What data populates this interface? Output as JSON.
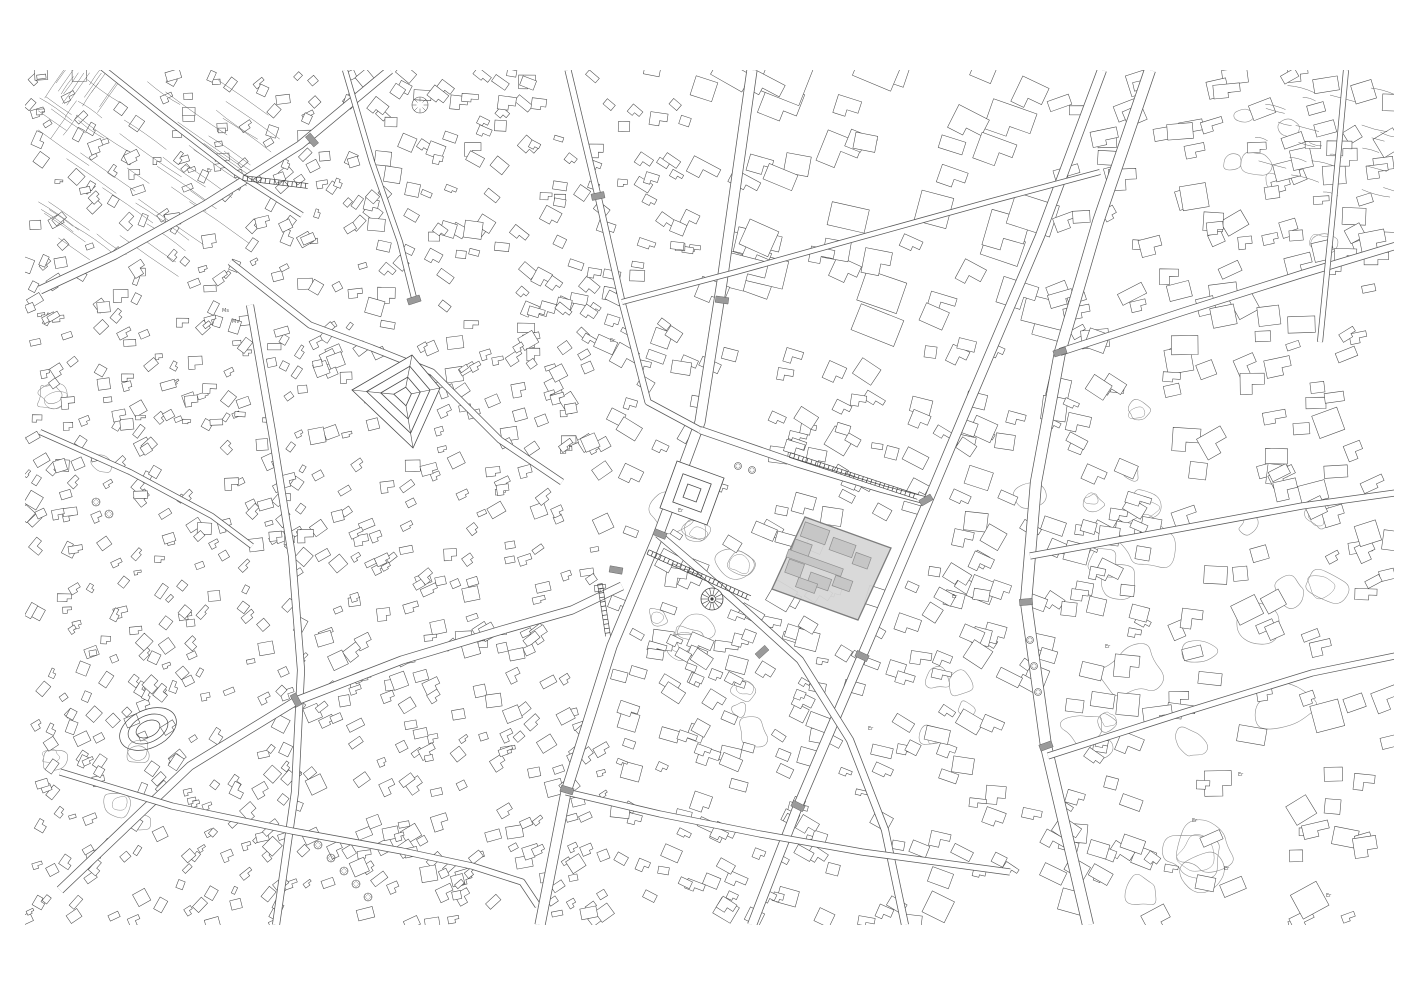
{
  "page": {
    "width": 1419,
    "height": 1000,
    "background": "#ffffff"
  },
  "map": {
    "x": 25,
    "y": 70,
    "w": 1369,
    "h": 855,
    "background": "#ffffff",
    "building_stroke": "#4a4a4a",
    "street_edge": "#5a5a5a",
    "park_stroke": "#8a8a8a",
    "crossing_fill": "#9a9a9a",
    "detail_stroke": "#3d3d3d",
    "seed": 20240521
  },
  "highlight": {
    "polygon": [
      [
        805,
        517
      ],
      [
        891,
        548
      ],
      [
        858,
        620
      ],
      [
        772,
        589
      ]
    ],
    "fill": "#d6d6d6",
    "stroke": "#7d7d7d",
    "angle_deg": 19.8,
    "building_fill": "#c6c6c6",
    "building_stroke": "#8e8e8e",
    "buildings_local": [
      {
        "a": 16,
        "b": 12,
        "w": 26,
        "h": 15
      },
      {
        "a": 47,
        "b": 16,
        "w": 24,
        "h": 13
      },
      {
        "a": 70,
        "b": 22,
        "w": 16,
        "h": 12
      },
      {
        "a": 10,
        "b": 32,
        "w": 18,
        "h": 16
      },
      {
        "a": 28,
        "b": 40,
        "w": 58,
        "h": 8
      },
      {
        "a": 12,
        "b": 52,
        "w": 16,
        "h": 14
      },
      {
        "a": 40,
        "b": 56,
        "w": 22,
        "h": 12
      },
      {
        "a": 62,
        "b": 50,
        "w": 18,
        "h": 11
      },
      {
        "a": 30,
        "b": 64,
        "w": 20,
        "h": 10
      }
    ]
  },
  "streets": [
    {
      "name": "nw-avenue",
      "w": 9,
      "pts": [
        [
          390,
          70
        ],
        [
          300,
          145
        ],
        [
          205,
          205
        ],
        [
          115,
          255
        ],
        [
          40,
          290
        ]
      ]
    },
    {
      "name": "nw-upper-lane",
      "w": 6,
      "pts": [
        [
          95,
          62
        ],
        [
          165,
          118
        ],
        [
          235,
          172
        ],
        [
          302,
          215
        ]
      ]
    },
    {
      "name": "old-town-lane",
      "w": 7,
      "pts": [
        [
          230,
          262
        ],
        [
          310,
          325
        ],
        [
          372,
          348
        ],
        [
          432,
          372
        ],
        [
          500,
          440
        ],
        [
          562,
          482
        ]
      ]
    },
    {
      "name": "left-vertical-street",
      "w": 8,
      "pts": [
        [
          250,
          305
        ],
        [
          272,
          432
        ],
        [
          292,
          556
        ],
        [
          301,
          670
        ],
        [
          295,
          792
        ],
        [
          276,
          925
        ]
      ]
    },
    {
      "name": "west-mid-lane",
      "w": 6,
      "pts": [
        [
          40,
          432
        ],
        [
          130,
          472
        ],
        [
          212,
          516
        ],
        [
          252,
          546
        ]
      ]
    },
    {
      "name": "sw-diagonal",
      "w": 9,
      "pts": [
        [
          60,
          890
        ],
        [
          190,
          766
        ],
        [
          296,
          701
        ],
        [
          402,
          660
        ],
        [
          502,
          630
        ],
        [
          572,
          610
        ],
        [
          622,
          586
        ]
      ]
    },
    {
      "name": "bottom-left-lane",
      "w": 7,
      "pts": [
        [
          60,
          772
        ],
        [
          172,
          806
        ],
        [
          292,
          831
        ],
        [
          402,
          851
        ],
        [
          472,
          866
        ],
        [
          522,
          882
        ],
        [
          538,
          906
        ]
      ]
    },
    {
      "name": "central-boulevard",
      "w": 11,
      "pts": [
        [
          752,
          70
        ],
        [
          722,
          282
        ],
        [
          700,
          422
        ],
        [
          658,
          536
        ],
        [
          612,
          646
        ],
        [
          566,
          792
        ],
        [
          540,
          925
        ]
      ]
    },
    {
      "name": "branch-east",
      "w": 8,
      "pts": [
        [
          700,
          430
        ],
        [
          796,
          463
        ],
        [
          882,
          489
        ],
        [
          928,
          501
        ]
      ]
    },
    {
      "name": "long-ne-sw-street",
      "w": 10,
      "pts": [
        [
          1102,
          70
        ],
        [
          1040,
          236
        ],
        [
          972,
          396
        ],
        [
          928,
          501
        ],
        [
          862,
          656
        ],
        [
          798,
          806
        ],
        [
          752,
          925
        ]
      ]
    },
    {
      "name": "top-mid-vertical",
      "w": 7,
      "pts": [
        [
          568,
          70
        ],
        [
          598,
          196
        ],
        [
          622,
          302
        ],
        [
          648,
          402
        ],
        [
          700,
          430
        ]
      ]
    },
    {
      "name": "top-left-vertical",
      "w": 6,
      "pts": [
        [
          345,
          70
        ],
        [
          372,
          162
        ],
        [
          400,
          242
        ],
        [
          415,
          302
        ]
      ]
    },
    {
      "name": "upper-cross-lane",
      "w": 6,
      "pts": [
        [
          622,
          302
        ],
        [
          736,
          272
        ],
        [
          858,
          238
        ],
        [
          988,
          202
        ],
        [
          1100,
          172
        ]
      ]
    },
    {
      "name": "right-avenue",
      "w": 12,
      "pts": [
        [
          1150,
          70
        ],
        [
          1098,
          222
        ],
        [
          1060,
          352
        ],
        [
          1036,
          482
        ],
        [
          1026,
          602
        ],
        [
          1046,
          746
        ],
        [
          1088,
          925
        ]
      ]
    },
    {
      "name": "right-cross-upper",
      "w": 8,
      "pts": [
        [
          1060,
          352
        ],
        [
          1182,
          312
        ],
        [
          1302,
          274
        ],
        [
          1395,
          246
        ]
      ]
    },
    {
      "name": "right-cross-mid",
      "w": 7,
      "pts": [
        [
          1030,
          556
        ],
        [
          1162,
          532
        ],
        [
          1302,
          506
        ],
        [
          1395,
          493
        ]
      ]
    },
    {
      "name": "right-cross-lower",
      "w": 7,
      "pts": [
        [
          1048,
          756
        ],
        [
          1182,
          713
        ],
        [
          1312,
          673
        ],
        [
          1395,
          656
        ]
      ]
    },
    {
      "name": "far-right-vertical",
      "w": 6,
      "pts": [
        [
          1346,
          70
        ],
        [
          1333,
          212
        ],
        [
          1320,
          342
        ]
      ]
    },
    {
      "name": "plaza-diagonal",
      "w": 8,
      "pts": [
        [
          658,
          534
        ],
        [
          700,
          570
        ],
        [
          745,
          610
        ],
        [
          800,
          660
        ],
        [
          850,
          740
        ],
        [
          885,
          830
        ],
        [
          905,
          925
        ]
      ]
    },
    {
      "name": "bottom-center-lane",
      "w": 7,
      "pts": [
        [
          566,
          792
        ],
        [
          660,
          814
        ],
        [
          760,
          834
        ],
        [
          862,
          852
        ],
        [
          1010,
          872
        ]
      ]
    }
  ],
  "crossings": [
    {
      "x": 312,
      "y": 140,
      "a": -40
    },
    {
      "x": 722,
      "y": 300,
      "a": 98
    },
    {
      "x": 660,
      "y": 534,
      "a": 112
    },
    {
      "x": 567,
      "y": 790,
      "a": 107
    },
    {
      "x": 926,
      "y": 500,
      "a": 60
    },
    {
      "x": 1060,
      "y": 352,
      "a": 72
    },
    {
      "x": 1026,
      "y": 602,
      "a": 85
    },
    {
      "x": 296,
      "y": 700,
      "a": -28
    },
    {
      "x": 598,
      "y": 196,
      "a": 78
    },
    {
      "x": 1046,
      "y": 746,
      "a": 70
    },
    {
      "x": 414,
      "y": 300,
      "a": 72
    },
    {
      "x": 862,
      "y": 656,
      "a": 115
    },
    {
      "x": 798,
      "y": 806,
      "a": 117
    },
    {
      "x": 616,
      "y": 570,
      "a": 100
    },
    {
      "x": 762,
      "y": 652,
      "a": 48
    }
  ],
  "ladders": [
    {
      "x1": 790,
      "y1": 455,
      "x2": 918,
      "y2": 497
    },
    {
      "x1": 243,
      "y1": 178,
      "x2": 308,
      "y2": 186
    },
    {
      "x1": 648,
      "y1": 552,
      "x2": 750,
      "y2": 598
    },
    {
      "x1": 600,
      "y1": 584,
      "x2": 608,
      "y2": 636
    }
  ],
  "zones": [
    {
      "x": 25,
      "y": 70,
      "w": 340,
      "h": 270,
      "d": 1.9,
      "smin": 7,
      "smax": 15,
      "ang": -35,
      "jit": 38
    },
    {
      "x": 365,
      "y": 70,
      "w": 330,
      "h": 270,
      "d": 1.5,
      "smin": 9,
      "smax": 18,
      "ang": 22,
      "jit": 22
    },
    {
      "x": 695,
      "y": 70,
      "w": 360,
      "h": 270,
      "d": 0.5,
      "smin": 20,
      "smax": 46,
      "ang": 20,
      "jit": 10
    },
    {
      "x": 1055,
      "y": 70,
      "w": 340,
      "h": 270,
      "d": 1.0,
      "smin": 13,
      "smax": 28,
      "ang": -14,
      "jit": 18
    },
    {
      "x": 25,
      "y": 340,
      "w": 280,
      "h": 310,
      "d": 1.9,
      "smin": 7,
      "smax": 15,
      "ang": -30,
      "jit": 34
    },
    {
      "x": 305,
      "y": 340,
      "w": 300,
      "h": 310,
      "d": 1.7,
      "smin": 8,
      "smax": 17,
      "ang": -20,
      "jit": 20
    },
    {
      "x": 605,
      "y": 340,
      "w": 330,
      "h": 310,
      "d": 0.9,
      "smin": 11,
      "smax": 24,
      "ang": 20,
      "jit": 14
    },
    {
      "x": 935,
      "y": 340,
      "w": 220,
      "h": 310,
      "d": 1.1,
      "smin": 12,
      "smax": 25,
      "ang": 20,
      "jit": 14
    },
    {
      "x": 1155,
      "y": 340,
      "w": 240,
      "h": 310,
      "d": 0.7,
      "smin": 13,
      "smax": 28,
      "ang": -10,
      "jit": 20
    },
    {
      "x": 25,
      "y": 650,
      "w": 280,
      "h": 275,
      "d": 1.9,
      "smin": 7,
      "smax": 15,
      "ang": -40,
      "jit": 30
    },
    {
      "x": 305,
      "y": 650,
      "w": 300,
      "h": 275,
      "d": 1.7,
      "smin": 8,
      "smax": 17,
      "ang": -25,
      "jit": 18
    },
    {
      "x": 605,
      "y": 650,
      "w": 330,
      "h": 275,
      "d": 1.2,
      "smin": 10,
      "smax": 21,
      "ang": 20,
      "jit": 14
    },
    {
      "x": 935,
      "y": 650,
      "w": 220,
      "h": 275,
      "d": 0.9,
      "smin": 12,
      "smax": 25,
      "ang": 20,
      "jit": 16
    },
    {
      "x": 1155,
      "y": 650,
      "w": 240,
      "h": 275,
      "d": 0.5,
      "smin": 13,
      "smax": 30,
      "ang": -10,
      "jit": 22
    }
  ],
  "parks": [
    {
      "cx": 705,
      "cy": 545,
      "n": 5,
      "spread": 45,
      "rmin": 10,
      "rmax": 26
    },
    {
      "cx": 668,
      "cy": 655,
      "n": 4,
      "spread": 40,
      "rmin": 10,
      "rmax": 22
    },
    {
      "cx": 745,
      "cy": 700,
      "n": 3,
      "spread": 35,
      "rmin": 8,
      "rmax": 18
    },
    {
      "cx": 1210,
      "cy": 600,
      "n": 10,
      "spread": 115,
      "rmin": 10,
      "rmax": 34
    },
    {
      "cx": 1190,
      "cy": 800,
      "n": 9,
      "spread": 115,
      "rmin": 10,
      "rmax": 34
    },
    {
      "cx": 1300,
      "cy": 170,
      "n": 6,
      "spread": 80,
      "rmin": 8,
      "rmax": 24
    },
    {
      "cx": 1090,
      "cy": 460,
      "n": 5,
      "spread": 60,
      "rmin": 8,
      "rmax": 22
    },
    {
      "cx": 90,
      "cy": 790,
      "n": 5,
      "spread": 55,
      "rmin": 8,
      "rmax": 20
    },
    {
      "cx": 60,
      "cy": 430,
      "n": 4,
      "spread": 45,
      "rmin": 8,
      "rmax": 18
    },
    {
      "cx": 950,
      "cy": 720,
      "n": 4,
      "spread": 45,
      "rmin": 8,
      "rmax": 18
    }
  ],
  "terraces": [
    {
      "x": 32,
      "y": 78,
      "w": 195,
      "h": 172,
      "ang": 35,
      "n": 46,
      "lmin": 25,
      "lmax": 80
    },
    {
      "x": 42,
      "y": 82,
      "w": 60,
      "h": 58,
      "ang": -55,
      "n": 16,
      "lmin": 20,
      "lmax": 48
    },
    {
      "x": 1245,
      "y": 85,
      "w": 145,
      "h": 120,
      "ang": 15,
      "n": 24,
      "lmin": 12,
      "lmax": 30
    }
  ],
  "landmarks": {
    "pyramid": {
      "corners": [
        [
          412,
          355
        ],
        [
          440,
          388
        ],
        [
          413,
          448
        ],
        [
          352,
          390
        ]
      ],
      "rings": [
        1,
        0.72,
        0.45,
        0.2
      ]
    },
    "inner_square": {
      "cx": 692,
      "cy": 493,
      "halves": [
        25,
        15,
        7
      ],
      "ang": 20
    },
    "plaza": {
      "cx": 712,
      "cy": 599,
      "r_outer": 11,
      "r_inner": 3.5,
      "spokes": 14
    },
    "oval": {
      "cx": 148,
      "cy": 729,
      "rx": 30,
      "ry": 19,
      "ang": -25,
      "rings": [
        1,
        0.7,
        0.42
      ]
    }
  },
  "trees": [
    [
      420,
      105,
      8
    ],
    [
      318,
      845,
      4
    ],
    [
      331,
      858,
      4
    ],
    [
      344,
      871,
      4
    ],
    [
      356,
      884,
      4
    ],
    [
      368,
      897,
      4
    ],
    [
      1030,
      640,
      3.5
    ],
    [
      1034,
      666,
      3.5
    ],
    [
      1038,
      692,
      3.5
    ],
    [
      96,
      502,
      4
    ],
    [
      109,
      514,
      4
    ],
    [
      738,
      466,
      3.5
    ],
    [
      752,
      470,
      3.5
    ]
  ],
  "labels": [
    {
      "x": 207,
      "y": 172,
      "t": "Er"
    },
    {
      "x": 610,
      "y": 342,
      "t": "Er"
    },
    {
      "x": 678,
      "y": 512,
      "t": "Er"
    },
    {
      "x": 222,
      "y": 312,
      "t": "Ms"
    },
    {
      "x": 232,
      "y": 323,
      "t": "Mv"
    },
    {
      "x": 1238,
      "y": 776,
      "t": "Er"
    },
    {
      "x": 1192,
      "y": 822,
      "t": "Er"
    },
    {
      "x": 1224,
      "y": 870,
      "t": "Er"
    },
    {
      "x": 1326,
      "y": 897,
      "t": "Er"
    },
    {
      "x": 1105,
      "y": 648,
      "t": "Er"
    },
    {
      "x": 868,
      "y": 730,
      "t": "Er"
    },
    {
      "x": 952,
      "y": 598,
      "t": "Er"
    }
  ]
}
